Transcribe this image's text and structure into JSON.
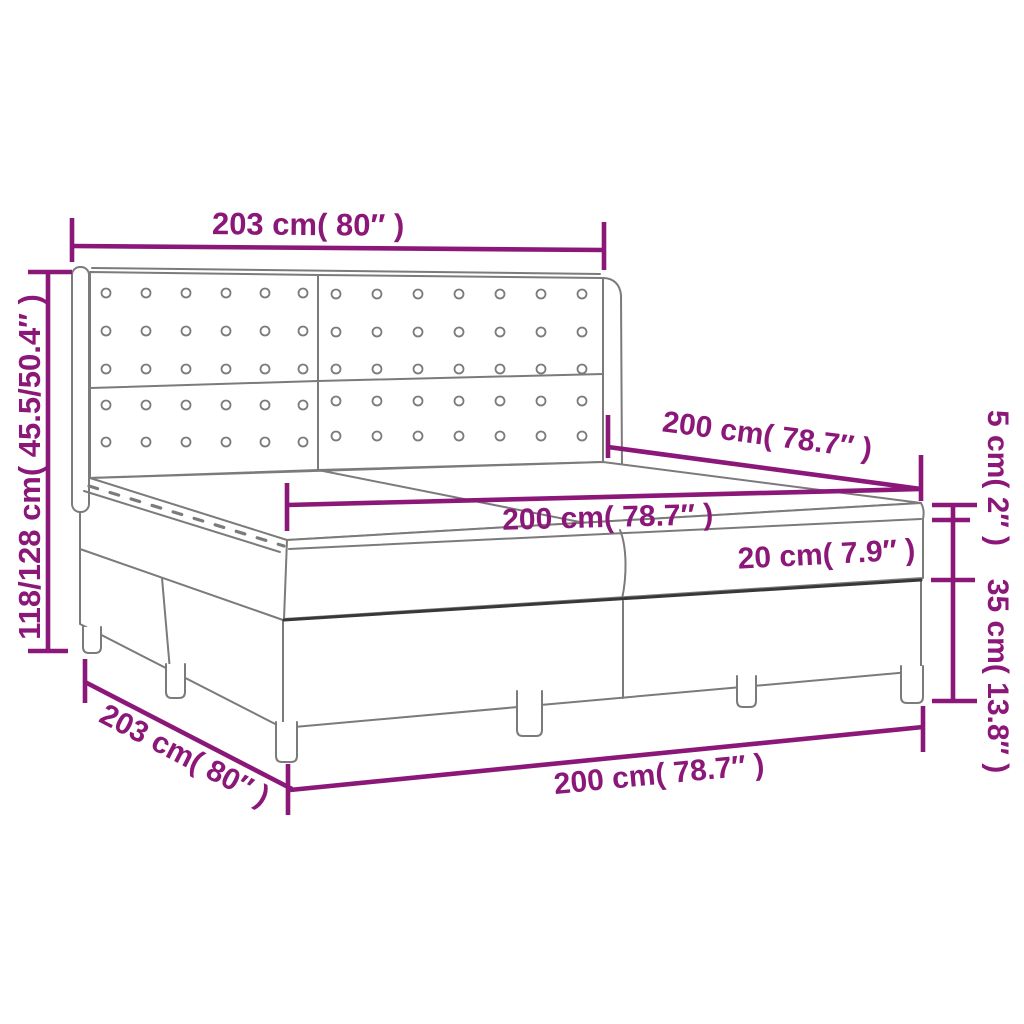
{
  "diagram": {
    "subject": "box spring bed with tufted wing headboard, mattress and topper",
    "accent_color": "#8B1878",
    "outline_color": "#7B7B7B",
    "dark_line_color": "#383838",
    "background_color": "#FFFFFF"
  },
  "labels": {
    "headboard_width": "203 cm( 80″ )",
    "headboard_height": "118/128 cm( 45.5/50.4″ )",
    "mattress_width": "200 cm( 78.7″ )",
    "mattress_length": "200 cm( 78.7″ )",
    "mattress_thickness": "20 cm( 7.9″ )",
    "topper_thickness": "5 cm( 2″ )",
    "base_height": "35 cm( 13.8″ )",
    "base_width": "203 cm( 80″ )",
    "base_length": "200 cm( 78.7″ )"
  },
  "values": {
    "headboard_width_cm": 203,
    "headboard_width_in": 80,
    "headboard_height_cm": "118/128",
    "headboard_height_in": "45.5/50.4",
    "mattress_width_cm": 200,
    "mattress_width_in": 78.7,
    "mattress_length_cm": 200,
    "mattress_length_in": 78.7,
    "mattress_thickness_cm": 20,
    "mattress_thickness_in": 7.9,
    "topper_thickness_cm": 5,
    "topper_thickness_in": 2,
    "base_height_cm": 35,
    "base_height_in": 13.8,
    "base_width_cm": 203,
    "base_width_in": 80,
    "base_length_cm": 200,
    "base_length_in": 78.7
  }
}
